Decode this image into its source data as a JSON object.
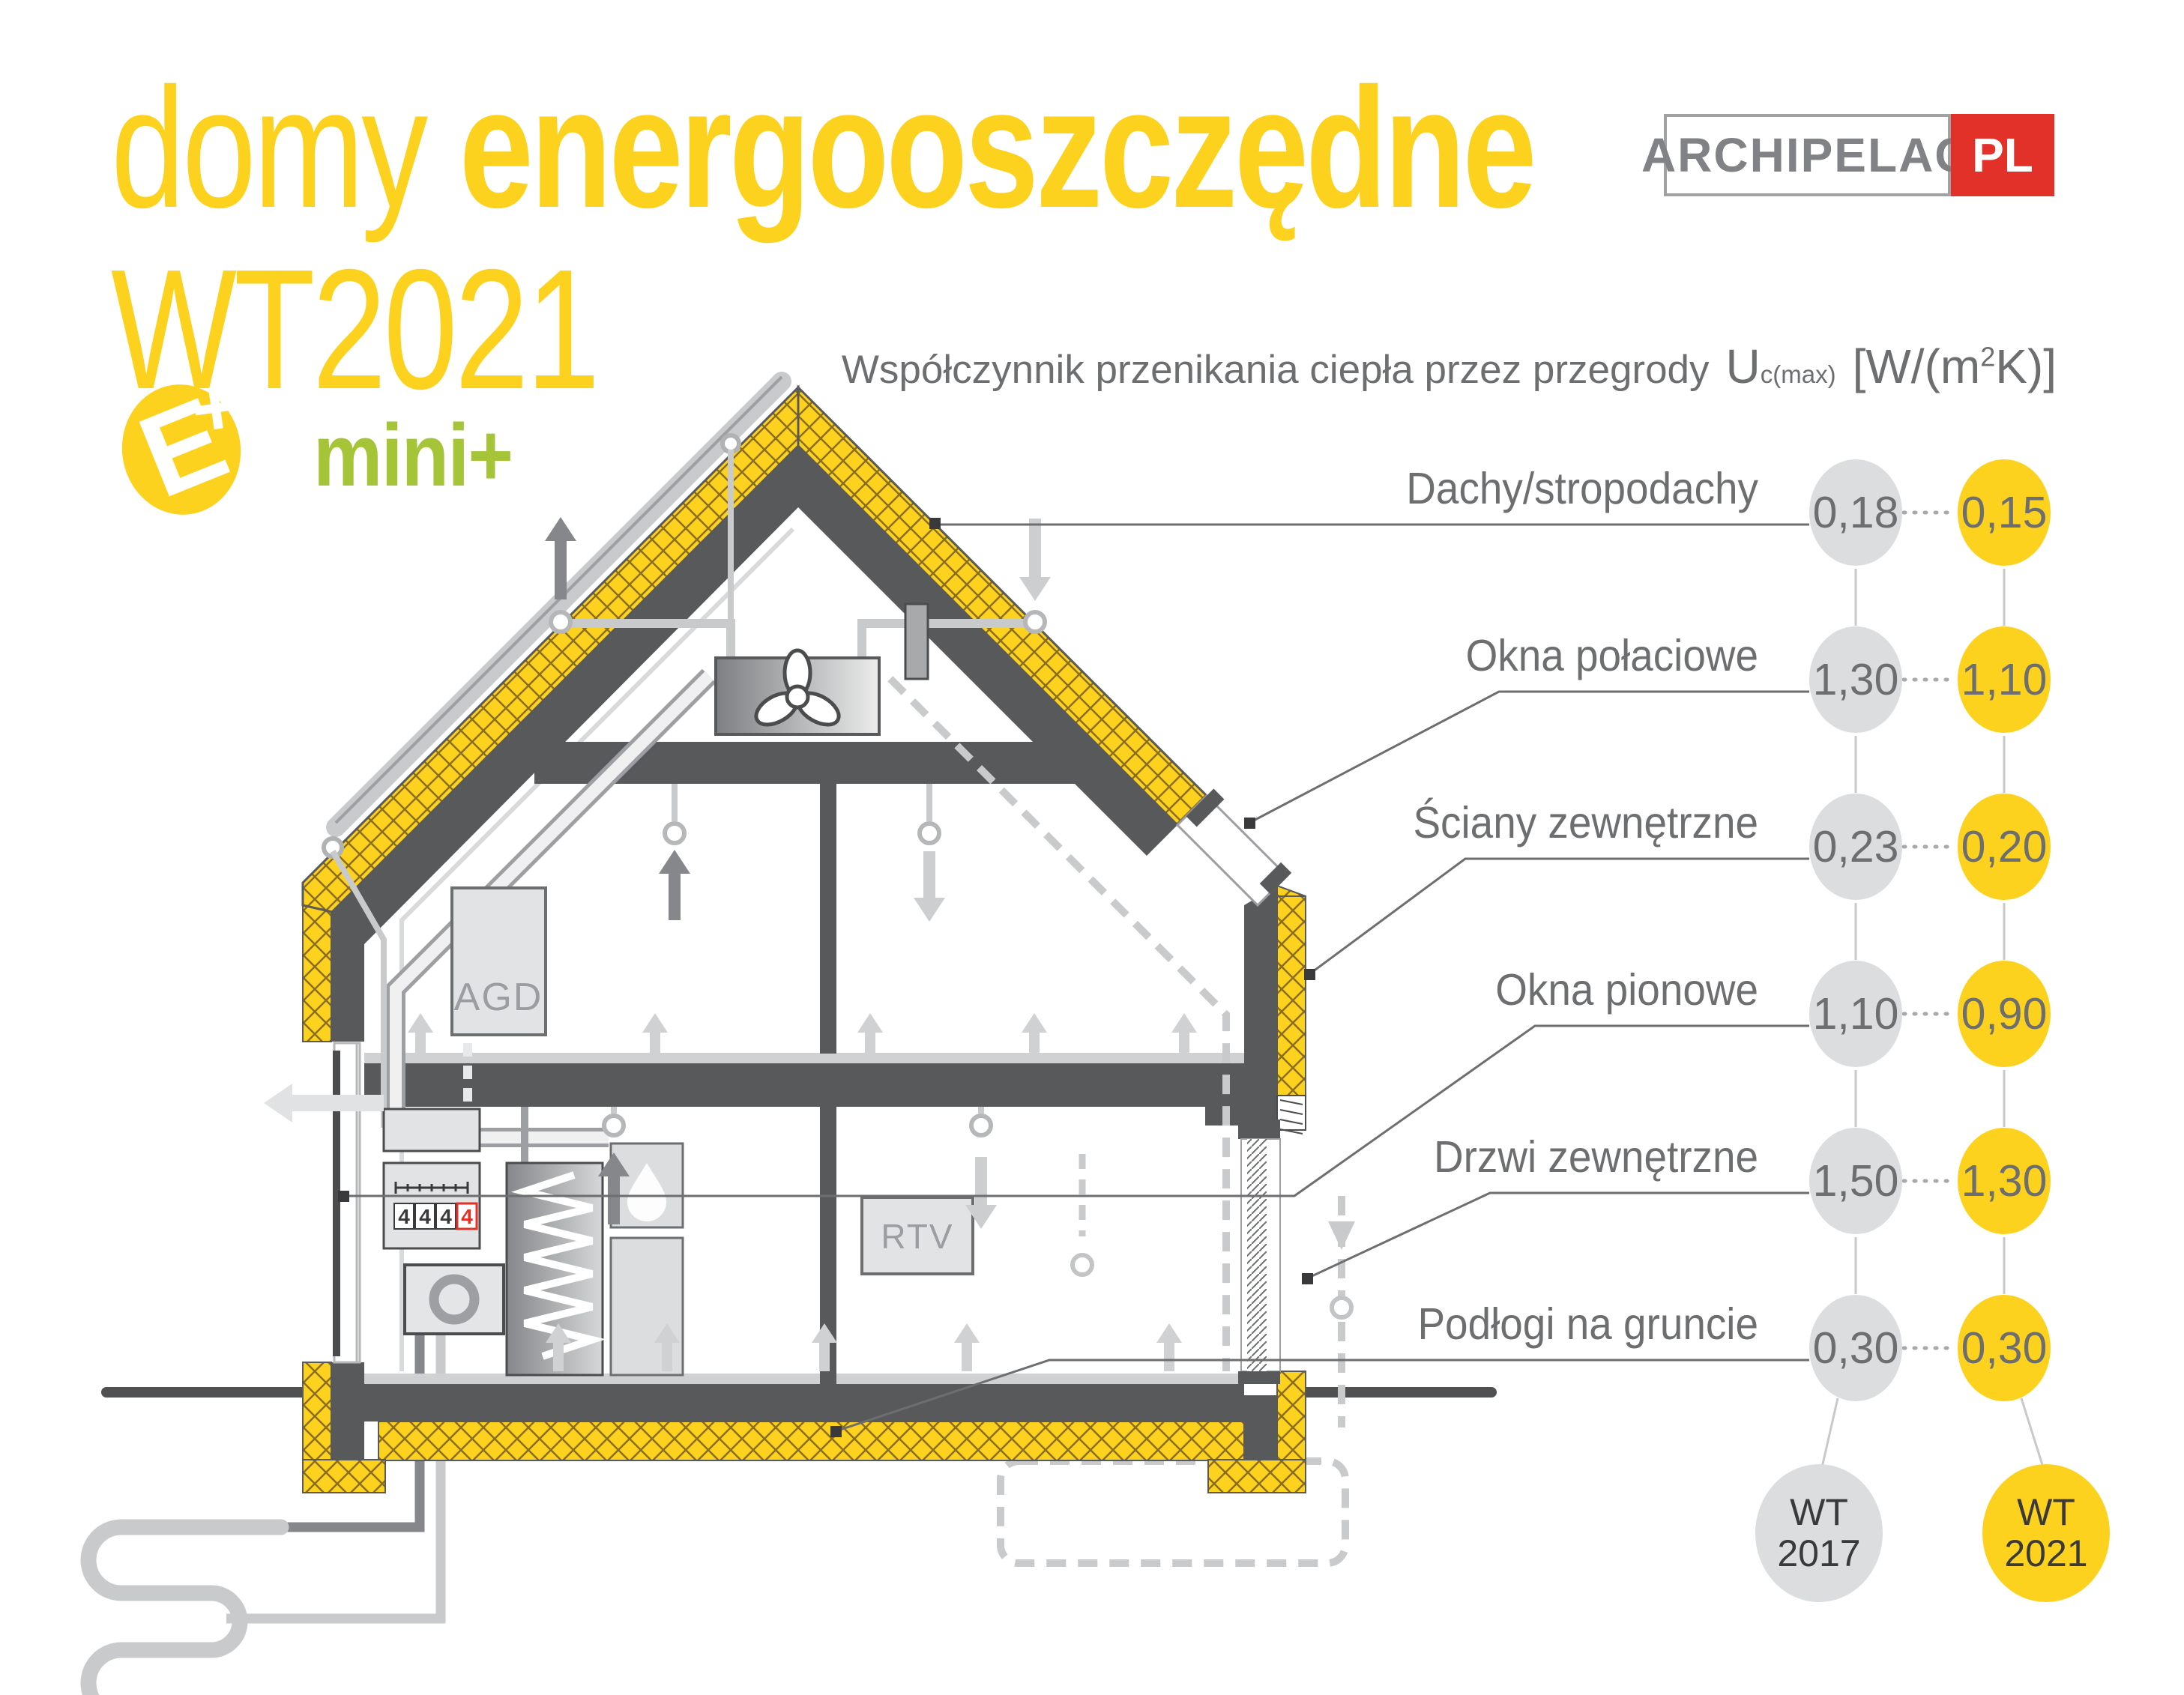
{
  "title": {
    "word_light": "domy",
    "word_bold": "energooszczędne",
    "line2": "WT2021",
    "color": "#fdd21e"
  },
  "standard_badge": {
    "letter": "E",
    "plus": "+",
    "label": "mini+",
    "circle_color": "#fdd21e",
    "label_color": "#a6c438"
  },
  "brand": {
    "name": "ARCHIPELAG",
    "tld": "PL",
    "tld_bg": "#e23128"
  },
  "header": {
    "text": "Współczynnik przenikania ciepła przez przegrody",
    "symbol": "U",
    "symbol_sub": "c(max)",
    "unit_open": "[W/(m",
    "unit_sup": "2",
    "unit_close": "K)]"
  },
  "comparison": {
    "rows": [
      {
        "label": "Dachy/stropodachy",
        "wt2017": "0,18",
        "wt2021": "0,15"
      },
      {
        "label": "Okna połaciowe",
        "wt2017": "1,30",
        "wt2021": "1,10"
      },
      {
        "label": "Ściany zewnętrzne",
        "wt2017": "0,23",
        "wt2021": "0,20"
      },
      {
        "label": "Okna pionowe",
        "wt2017": "1,10",
        "wt2021": "0,90"
      },
      {
        "label": "Drzwi zewnętrzne",
        "wt2017": "1,50",
        "wt2021": "1,30"
      },
      {
        "label": "Podłogi na gruncie",
        "wt2017": "0,30",
        "wt2021": "0,30"
      }
    ],
    "legend_2017": {
      "line1": "WT",
      "line2": "2017",
      "color": "#dcddde"
    },
    "legend_2021": {
      "line1": "WT",
      "line2": "2021",
      "color": "#fdd21e"
    }
  },
  "house": {
    "appliance_label": "AGD",
    "media_label": "RTV",
    "meter_digits": [
      "4",
      "4",
      "4",
      "4"
    ]
  },
  "colors": {
    "structure": "#58595b",
    "insulation": "#fdd21e",
    "duct": "#c9cacc",
    "text": "#6d6e70",
    "red": "#e23128",
    "green": "#a6c438"
  }
}
